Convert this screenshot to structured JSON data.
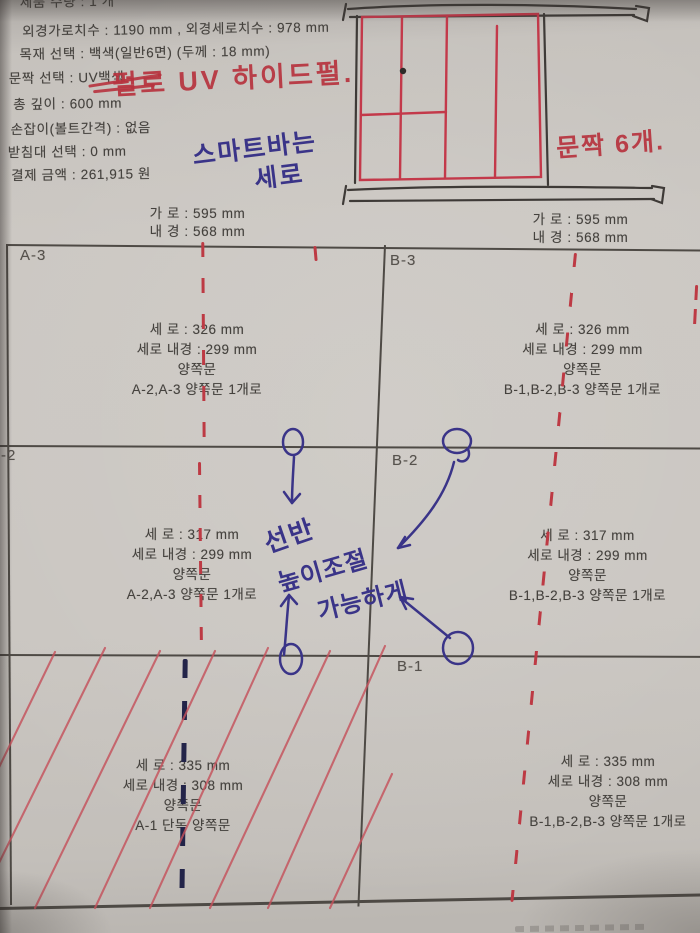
{
  "order": {
    "clipped_line": "제품 수량 : 1 개",
    "spec_lines": [
      "외경가로치수 : 1190 mm , 외경세로치수 : 978 mm",
      "목재 선택 : 백색(일반6면) (두께 : 18 mm)",
      "문짝 선택 : UV백색",
      "총 깊이 : 600 mm",
      "손잡이(볼트간격) : 없음",
      "받침대 선택 : 0 mm",
      "결제 금액 : 261,915 원"
    ]
  },
  "handwriting": {
    "red_finish_note": "펄로 UV 하이드펄.",
    "red_doors_note": "문짝 6개.",
    "blue_smartbar_line1": "스마트바는",
    "blue_smartbar_line2": "세로",
    "blue_shelf_word1": "선반",
    "blue_shelf_word2": "높이조절",
    "blue_shelf_word3": "가능하게"
  },
  "grid": {
    "left_header": {
      "line1": "가 로 : 595 mm",
      "line2": "내 경 : 568 mm"
    },
    "right_header": {
      "line1": "가 로 : 595 mm",
      "line2": "내 경 : 568 mm"
    },
    "cells": [
      {
        "label": "A-3",
        "l1": "세 로 : 326 mm",
        "l2": "세로 내경 : 299 mm",
        "l3": "양쪽문",
        "l4": "A-2,A-3 양쪽문 1개로"
      },
      {
        "label": "B-3",
        "l1": "세 로 : 326 mm",
        "l2": "세로 내경 : 299 mm",
        "l3": "양쪽문",
        "l4": "B-1,B-2,B-3 양쪽문 1개로"
      },
      {
        "label": "-2",
        "l1": "세 로 : 317 mm",
        "l2": "세로 내경 : 299 mm",
        "l3": "양쪽문",
        "l4": "A-2,A-3 양쪽문 1개로"
      },
      {
        "label": "B-2",
        "l1": "세 로 : 317 mm",
        "l2": "세로 내경 : 299 mm",
        "l3": "양쪽문",
        "l4": "B-1,B-2,B-3 양쪽문 1개로"
      },
      {
        "label": "",
        "l1": "세 로 : 335 mm",
        "l2": "세로 내경 : 308 mm",
        "l3": "양쪽문",
        "l4": "A-1 단독 양쪽문"
      },
      {
        "label": "B-1",
        "l1": "세 로 : 335 mm",
        "l2": "세로 내경 : 308 mm",
        "l3": "양쪽문",
        "l4": "B-1,B-2,B-3 양쪽문 1개로"
      }
    ]
  },
  "colors": {
    "red_pen": "#b7333e",
    "blue_pen": "#3a3488",
    "dark_dash": "#232449",
    "print_ink": "#45423e",
    "grid_line": "#4e4a45"
  }
}
